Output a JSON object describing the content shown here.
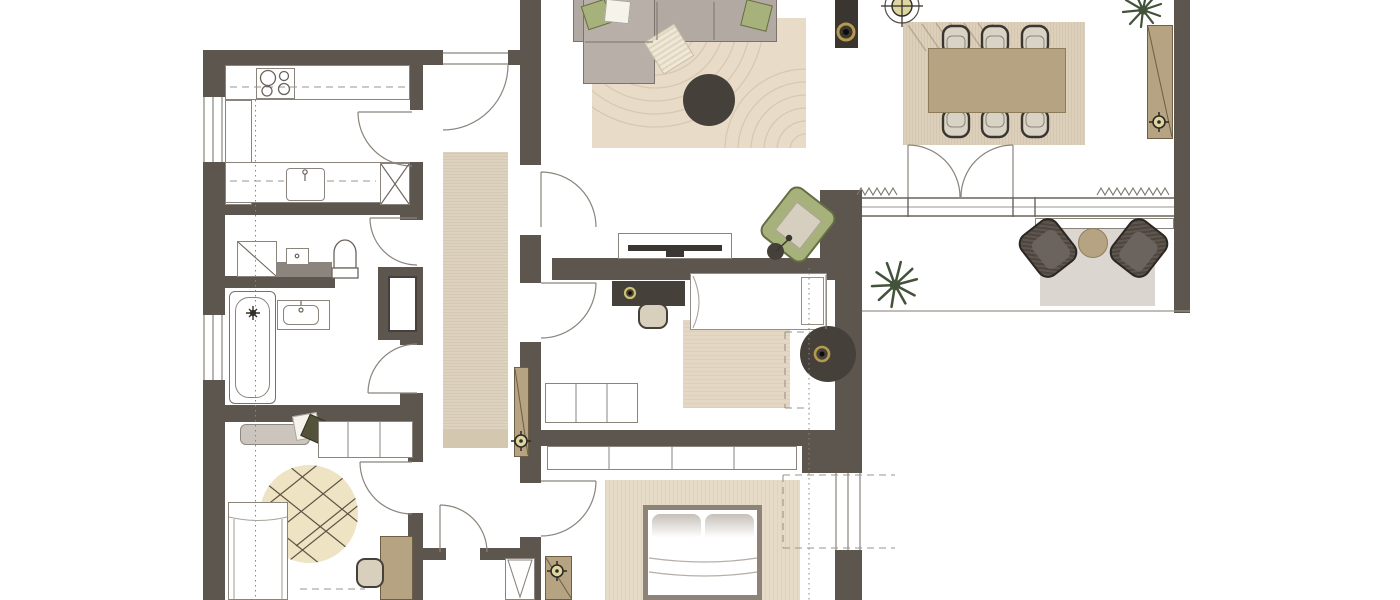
{
  "title": "Apartment floor plan – top-down architectural drawing",
  "colors": {
    "wall": "#5d564e",
    "line": "#8a847c",
    "dark": "#46403a",
    "ink": "#2e2a24",
    "rug_living": "#e8dcc9",
    "rug_pattern": "#d8c8b1",
    "rug_dining": "#ddd0bb",
    "rug_runner": "#ddd2bd",
    "rug_runner_end": "#d3c7b0",
    "rug_bedroom": "#e4d8c4",
    "rug_master": "#e6dbc7",
    "rug_balcony": "#dbd6cf",
    "rug_round": "#eee3c3",
    "tan": "#b5a382",
    "tan_border": "#6d5f45",
    "sofa": "#b1a9a2",
    "sofa_border": "#7c746c",
    "green": "#a7b17b",
    "green_border": "#656d42",
    "cushion": "#d6cfbf",
    "chair_light": "#d9d3c6",
    "wicker": "#4e463e",
    "wicker_border": "#2b2722",
    "wicker_cushion": "#6b645e",
    "gold": "#b39a4f",
    "gold_pale": "#ded6a0",
    "plant": "#43523a",
    "gray_block": "#8b857d",
    "olive_pillow": "#53523a",
    "bed_frame": "#8d8379",
    "white": "#ffffff"
  },
  "rooms": [
    {
      "id": "kitchen",
      "items": [
        "counter",
        "cooktop",
        "sink",
        "appliance-box"
      ]
    },
    {
      "id": "wc",
      "items": [
        "shower",
        "washbasin",
        "toilet"
      ]
    },
    {
      "id": "bathroom",
      "items": [
        "bathtub",
        "vanity-washbasin"
      ]
    },
    {
      "id": "kids-room",
      "items": [
        "daybed",
        "pillows",
        "wardrobe",
        "round-rug",
        "bed",
        "desk",
        "chair"
      ]
    },
    {
      "id": "hallway",
      "items": [
        "entrance-door",
        "runner-rug",
        "wall-console",
        "closet"
      ]
    },
    {
      "id": "living-room",
      "items": [
        "corner-sofa",
        "pillows",
        "throw",
        "rug",
        "coffee-table",
        "tv-console",
        "tv",
        "armchair",
        "floor-lamp",
        "column"
      ]
    },
    {
      "id": "dining-room",
      "items": [
        "rug",
        "dining-table",
        "six-chairs",
        "ceiling-light",
        "plant",
        "sideboard"
      ]
    },
    {
      "id": "balcony",
      "items": [
        "french-doors",
        "planter-bench",
        "plant",
        "rug",
        "two-lounge-chairs",
        "side-table"
      ]
    },
    {
      "id": "bedroom",
      "items": [
        "desk",
        "chair",
        "single-bed",
        "rug",
        "pendant-light",
        "wardrobe"
      ]
    },
    {
      "id": "master-bedroom",
      "items": [
        "wardrobe",
        "double-bed",
        "rug",
        "tall-cabinet"
      ]
    }
  ]
}
